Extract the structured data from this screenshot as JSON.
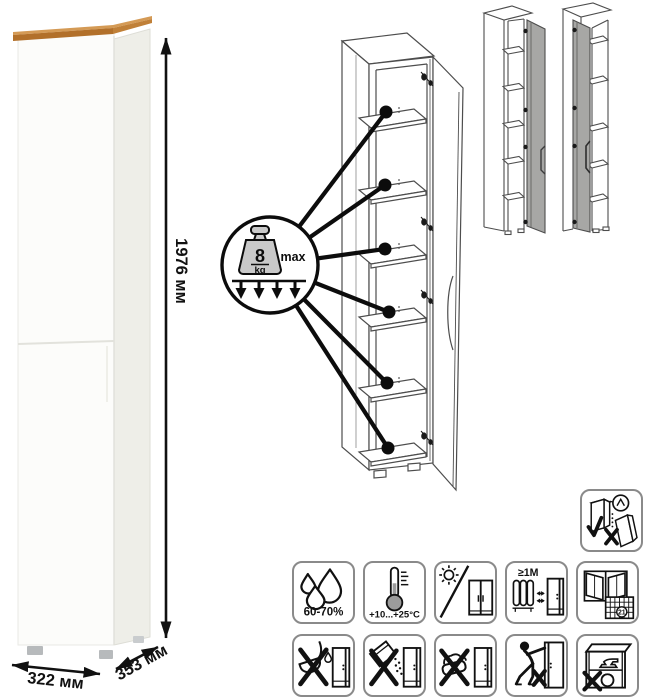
{
  "product": {
    "dimensions": {
      "height": "1976 мм",
      "width": "322 мм",
      "depth": "353 мм"
    },
    "colors": {
      "wood_top_light": "#d49a55",
      "wood_top_front": "#b2702a",
      "wood_top_side": "#c08038",
      "body": "#fcfcfa",
      "side": "#eeeee8",
      "feet": "#b7babc",
      "mini_door_gray": "#a7a7a5"
    }
  },
  "shelf_load": {
    "value": "8",
    "unit": "kg",
    "qualifier": "max"
  },
  "care": {
    "humidity_label": "60-70%",
    "temperature_label": "+10...+25°C",
    "distance_label": "≥1М",
    "calendar_day": "21"
  },
  "icon_names": {
    "warning": "secure-to-wall",
    "row1": [
      "humidity-range",
      "temperature-range",
      "avoid-direct-sunlight",
      "keep-1m-from-heat",
      "ventilate-room"
    ],
    "row2": [
      "no-aggressive-liquids",
      "no-abrasive-powders",
      "no-wet-cleaning",
      "no-dragging",
      "no-heavy-items"
    ]
  }
}
